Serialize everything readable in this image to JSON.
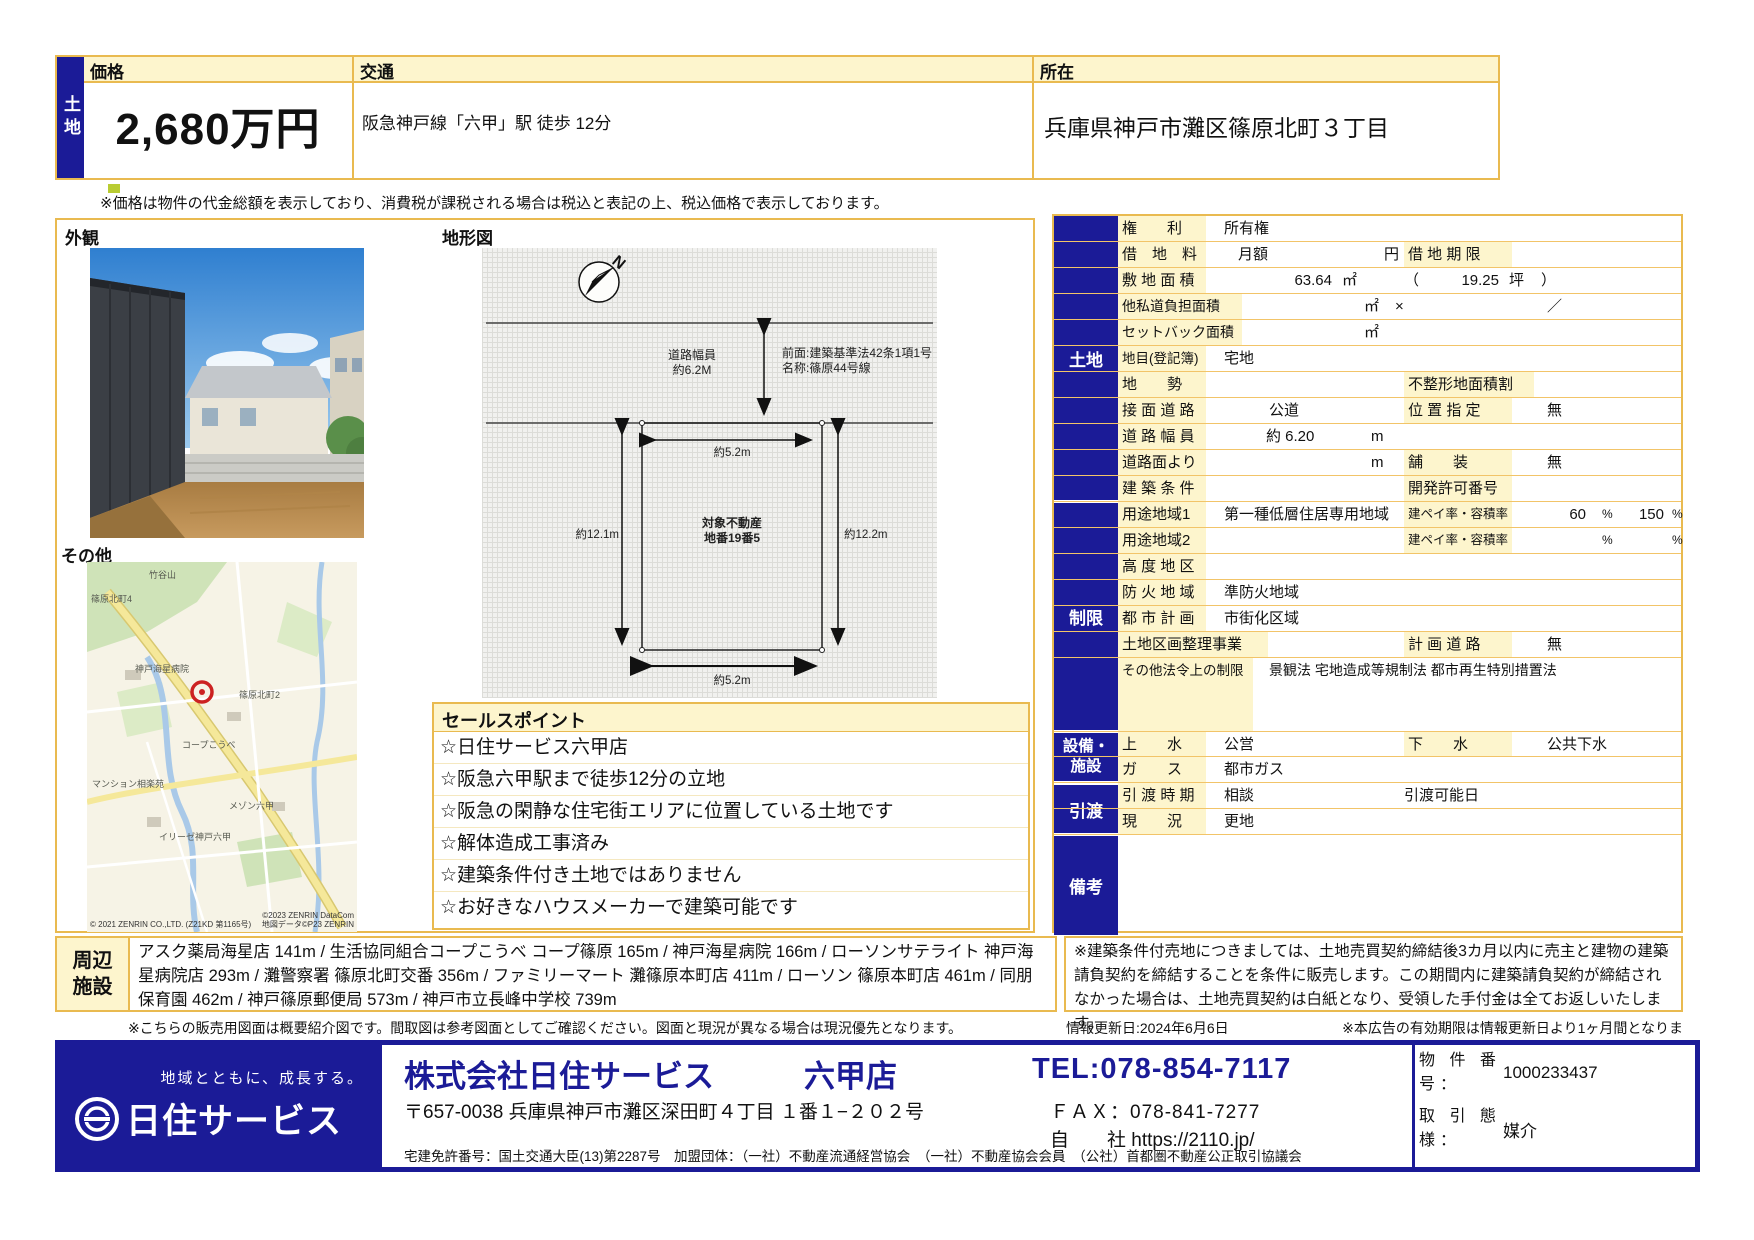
{
  "colors": {
    "navy": "#1b1b97",
    "label_yellow": "#fdf5cd",
    "border_orange": "#e9ba50",
    "marker_red": "#cc2222",
    "footer_blue_text": "#1b1b97"
  },
  "header": {
    "property_type": "土地",
    "price_label": "価格",
    "price_value": "2,680万円",
    "transport_label": "交通",
    "transport_value": "阪急神戸線「六甲」駅 徒歩 12分",
    "location_label": "所在",
    "location_value": "兵庫県神戸市灘区篠原北町３丁目",
    "tax_note": "※価格は物件の代金総額を表示しており、消費税が課税される場合は税込と表記の上、税込価格で表示しております。"
  },
  "left": {
    "exterior_label": "外観",
    "siteplan_label": "地形図",
    "other_label": "その他"
  },
  "siteplan": {
    "compass_n": "N",
    "road_width_note": "道路幅員\n約6.2M",
    "front_note": "前面:建築基準法42条1項1号\n名称:篠原44号線",
    "width_top": "約5.2m",
    "depth_left": "約12.1m",
    "depth_right": "約12.2m",
    "parcel_note": "対象不動産\n地番19番5",
    "width_bottom": "約5.2m"
  },
  "map": {
    "labels": [
      "竹谷山",
      "篠原北町4",
      "神戸海星病院",
      "篠原北町2",
      "コープこうべ",
      "マンション相楽苑",
      "メゾン六甲",
      "イリーゼ神戸六甲"
    ],
    "attr1": "© 2021 ZENRIN CO.,LTD. (Z21KD 第1165号)",
    "attr2": "©2023 ZENRIN DataCom",
    "attr3": "地図データ©P23 ZENRIN"
  },
  "sales": {
    "title": "セールスポイント",
    "items": [
      "☆日住サービス六甲店",
      "☆阪急六甲駅まで徒歩12分の立地",
      "☆阪急の閑静な住宅街エリアに位置している土地です",
      "☆解体造成工事済み",
      "☆建築条件付き土地ではありません",
      "☆お好きなハウスメーカーで建築可能です"
    ]
  },
  "table": {
    "sections": [
      "土地",
      "制限",
      "設備・\n施設",
      "引渡",
      "備考"
    ],
    "rows": [
      {
        "label": "権　　利",
        "v1": "所有権"
      },
      {
        "label": "借　地　料",
        "v1": "月額",
        "u1": "円",
        "l2": "借 地 期 限"
      },
      {
        "label": "敷 地 面 積",
        "n1": "63.64",
        "u1": "㎡",
        "p1": "（",
        "n2": "19.25",
        "u2": "坪",
        "p2": "）"
      },
      {
        "label": "他私道負担面積",
        "u1": "㎡",
        "x1": "×",
        "x2": "／"
      },
      {
        "label": "セットバック面積",
        "u1": "㎡"
      },
      {
        "label": "地目(登記簿)",
        "v1": "宅地"
      },
      {
        "label": "地　　勢",
        "l2": "不整形地面積割"
      },
      {
        "label": "接 面 道 路",
        "v1": "公道",
        "l2": "位 置 指 定",
        "v2": "無"
      },
      {
        "label": "道 路 幅 員",
        "v1": "約 6.20",
        "u1": "m"
      },
      {
        "label": "道路面より",
        "u1": "m",
        "l2": "舗　　装",
        "v2": "無"
      },
      {
        "label": "建 築 条 件",
        "l2": "開発許可番号"
      },
      {
        "label": "用途地域1",
        "v1": "第一種低層住居専用地域",
        "l2": "建ペイ率・容積率",
        "n1": "60",
        "p1": "%",
        "n2": "150",
        "p2": "%"
      },
      {
        "label": "用途地域2",
        "l2": "建ペイ率・容積率",
        "p1": "%",
        "p2": "%"
      },
      {
        "label": "高 度 地 区"
      },
      {
        "label": "防 火 地 域",
        "v1": "準防火地域"
      },
      {
        "label": "都 市 計 画",
        "v1": "市街化区域"
      },
      {
        "label": "土地区画整理事業",
        "l2": "計 画 道 路",
        "v2": "無"
      },
      {
        "label": "その他法令上の制限",
        "v1": "景観法 宅地造成等規制法 都市再生特別措置法"
      },
      {
        "label": "上　　水",
        "v1": "公営",
        "l2": "下　　水",
        "v2": "公共下水"
      },
      {
        "label": "ガ　　ス",
        "v1": "都市ガス"
      },
      {
        "label": "引 渡 時 期",
        "v1": "相談",
        "m1": "引渡可能日"
      },
      {
        "label": "現　　況",
        "v1": "更地"
      }
    ]
  },
  "nearby": {
    "label": "周辺\n施設",
    "text": "アスク薬局海星店 141m / 生活協同組合コープこうべ コープ篠原 165m / 神戸海星病院 166m / ローソンサテライト 神戸海星病院店 293m / 灘警察署 篠原北町交番 356m / ファミリーマート 灘篠原本町店 411m / ローソン 篠原本町店 461m / 同朋保育園 462m / 神戸篠原郵便局 573m / 神戸市立長峰中学校 739m"
  },
  "notes": {
    "condition_note": "※建築条件付売地につきましては、土地売買契約締結後3カ月以内に売主と建物の建築請負契約を締結することを条件に販売します。この期間内に建築請負契約が締結されなかった場合は、土地売買契約は白紙となり、受領した手付金は全てお返しいたします。",
    "figure_note": "※こちらの販売用図面は概要紹介図です。間取図は参考図面としてご確認ください。図面と現況が異なる場合は現況優先となります。",
    "update_date": "情報更新日:2024年6月6日",
    "validity_note": "※本広告の有効期限は情報更新日より1ヶ月間となります。"
  },
  "footer": {
    "tagline": "地域とともに、成長する。",
    "logo_text": "日住サービス",
    "company": "株式会社日住サービス",
    "branch": "六甲店",
    "address": "〒657-0038 兵庫県神戸市灘区深田町４丁目 １番１−２０２号",
    "tel": "TEL:078-854-7117",
    "fax_label": "ＦＡＸ：",
    "fax": "078-841-7277",
    "web_label": "自　　社",
    "web": "https://2110.jp/",
    "license": "宅建免許番号：国土交通大臣(13)第2287号　加盟団体：（一社）不動産流通経営協会　（一社）不動産協会会員　（公社）首都圏不動産公正取引協議会",
    "property_no_label": "物 件 番 号：",
    "property_no": "1000233437",
    "deal_type_label": "取 引 態 様：",
    "deal_type": "媒介"
  }
}
